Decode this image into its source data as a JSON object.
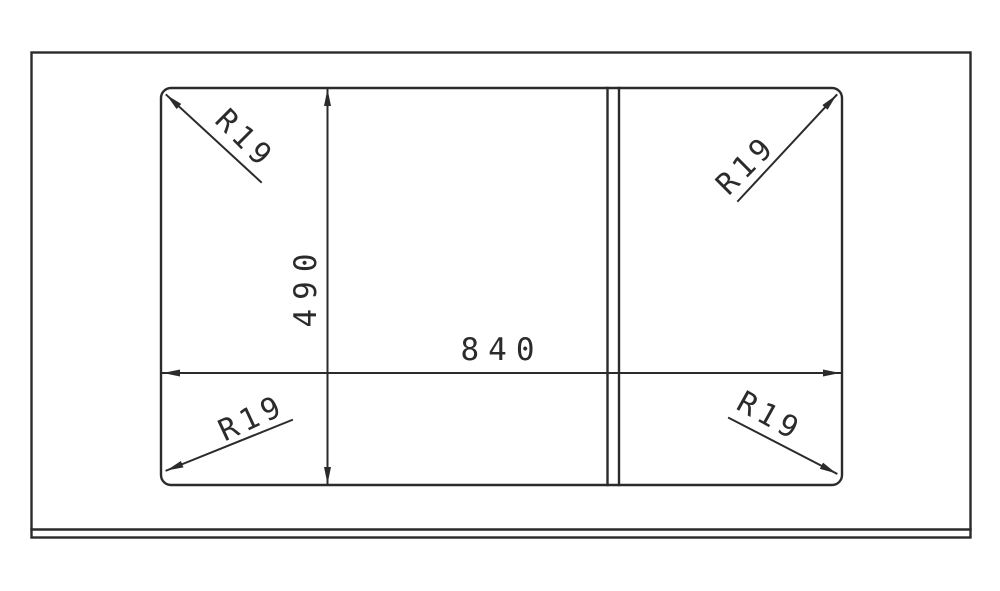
{
  "colors": {
    "line": "#2b2b2b",
    "background": "#ffffff"
  },
  "dimensions": {
    "width": {
      "label": "840",
      "value": 840
    },
    "height": {
      "label": "490",
      "value": 490
    }
  },
  "corner_radius_labels": {
    "top_left": "R19",
    "top_right": "R19",
    "bottom_left": "R19",
    "bottom_right": "R19"
  }
}
